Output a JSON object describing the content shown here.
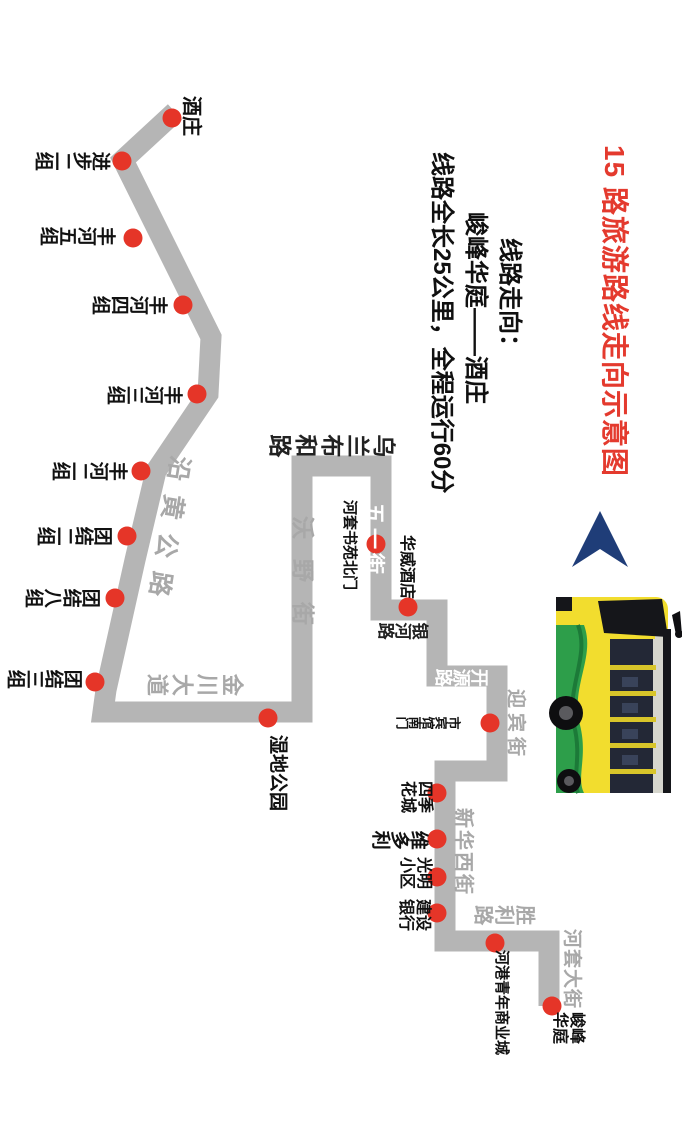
{
  "title": {
    "text": "15 路旅游路线走向示意图",
    "color": "#e43a2e"
  },
  "info": {
    "line1": "线路走向：",
    "line2": "峻峰华庭——酒庄",
    "line3": "线路全长25公里，全程运行60分"
  },
  "route": {
    "color": "#b5b5b5",
    "width": 21,
    "points": [
      [
        175,
        112
      ],
      [
        123,
        160
      ],
      [
        211,
        337
      ],
      [
        208,
        394
      ],
      [
        156,
        471
      ],
      [
        135,
        560
      ],
      [
        106,
        690
      ],
      [
        103,
        712
      ],
      [
        302,
        712
      ],
      [
        302,
        466
      ],
      [
        381,
        466
      ],
      [
        381,
        610
      ],
      [
        437,
        610
      ],
      [
        437,
        676
      ],
      [
        497,
        676
      ],
      [
        497,
        771
      ],
      [
        445,
        771
      ],
      [
        445,
        941
      ],
      [
        549,
        941
      ],
      [
        549,
        1006
      ]
    ]
  },
  "stops": {
    "color": "#e53528",
    "radius": 9.5,
    "items": [
      {
        "name": "酒庄",
        "x": 172,
        "y": 118,
        "type": "A",
        "lx": 201,
        "ly": 96,
        "size": 20
      },
      {
        "name": "进步二组",
        "x": 122,
        "y": 161,
        "type": "B",
        "lx": 111,
        "ly": 149,
        "size": 19
      },
      {
        "name": "丰河五组",
        "x": 133,
        "y": 238,
        "type": "B",
        "lx": 116,
        "ly": 224,
        "size": 19
      },
      {
        "name": "丰河四组",
        "x": 183,
        "y": 305,
        "type": "B",
        "lx": 168,
        "ly": 293,
        "size": 19
      },
      {
        "name": "丰河三组",
        "x": 197,
        "y": 394,
        "type": "B",
        "lx": 183,
        "ly": 383,
        "size": 19
      },
      {
        "name": "丰河二组",
        "x": 141,
        "y": 471,
        "type": "B",
        "lx": 128,
        "ly": 459,
        "size": 19
      },
      {
        "name": "团结二组",
        "x": 127,
        "y": 536,
        "type": "B",
        "lx": 113,
        "ly": 524,
        "size": 19
      },
      {
        "name": "团结八组",
        "x": 115,
        "y": 598,
        "type": "B",
        "lx": 101,
        "ly": 586,
        "size": 19
      },
      {
        "name": "团结三组",
        "x": 95,
        "y": 682,
        "type": "B",
        "lx": 83,
        "ly": 667,
        "size": 19
      },
      {
        "name": "湿地公园",
        "x": 268,
        "y": 718,
        "type": "A",
        "lx": 287,
        "ly": 735,
        "size": 19
      },
      {
        "name": "河套书苑北门",
        "x": 376,
        "y": 544,
        "type": "A",
        "lx": 357,
        "ly": 500,
        "size": 15
      },
      {
        "name": "华威酒店",
        "x": 408,
        "y": 607,
        "type": "A",
        "lx": 414,
        "ly": 535,
        "size": 16
      },
      {
        "name": "市宾馆南门",
        "x": 490,
        "y": 723,
        "type": "B",
        "lx": 461,
        "ly": 715,
        "size": 13
      },
      {
        "name": "四季花城",
        "text": "四季\n花城",
        "x": 437,
        "y": 793,
        "type": "C",
        "lx": 432,
        "ly": 781,
        "size": 16
      },
      {
        "name": "维多利",
        "x": 437,
        "y": 839,
        "type": "B",
        "lx": 429,
        "ly": 828,
        "size": 19
      },
      {
        "name": "光明小区",
        "text": "光明\n小区",
        "x": 437,
        "y": 877,
        "type": "C",
        "lx": 431,
        "ly": 857,
        "size": 16
      },
      {
        "name": "建设银行",
        "text": "建设\n银行",
        "x": 437,
        "y": 913,
        "type": "C",
        "lx": 430,
        "ly": 899,
        "size": 16
      },
      {
        "name": "河港青年商业城",
        "x": 495,
        "y": 943,
        "type": "A",
        "lx": 509,
        "ly": 950,
        "size": 15
      },
      {
        "name": "峻峰华庭",
        "text": "峻峰\n华庭",
        "x": 552,
        "y": 1006,
        "type": "C",
        "lx": 584,
        "ly": 1012,
        "size": 16
      }
    ]
  },
  "roads": {
    "items": [
      {
        "name": "沿黄公路",
        "type": "A",
        "lx": 193,
        "ly": 458,
        "size": 25,
        "spacing": 14,
        "angle": 99,
        "color": "#a8a8a8",
        "weight": 600
      },
      {
        "name": "金川大道",
        "type": "B",
        "lx": 244,
        "ly": 671,
        "size": 22,
        "spacing": 3,
        "color": "#a8a8a8",
        "weight": 600
      },
      {
        "name": "沃野街",
        "type": "A",
        "lx": 314,
        "ly": 516,
        "size": 23,
        "spacing": 20,
        "color": "#a8a8a8",
        "weight": 600
      },
      {
        "name": "乌兰布和路",
        "type": "B",
        "lx": 396,
        "ly": 431,
        "size": 23,
        "spacing": 3,
        "color": "#222222",
        "weight": 700
      },
      {
        "name": "五一街",
        "type": "A",
        "lx": 384,
        "ly": 503,
        "size": 21,
        "spacing": 4,
        "color": "#ffffff",
        "weight": 700
      },
      {
        "name": "银河路",
        "type": "B",
        "lx": 429,
        "ly": 620,
        "size": 17,
        "spacing": 0,
        "color": "#222222",
        "weight": 700
      },
      {
        "name": "开源路",
        "type": "B",
        "lx": 489,
        "ly": 667,
        "size": 18,
        "spacing": 0,
        "color": "#ffffff",
        "weight": 700
      },
      {
        "name": "迎宾街",
        "type": "A",
        "lx": 525,
        "ly": 689,
        "size": 19,
        "spacing": 5,
        "color": "#a8a8a8",
        "weight": 600
      },
      {
        "name": "新华西街",
        "type": "A",
        "lx": 473,
        "ly": 808,
        "size": 20,
        "spacing": 2,
        "color": "#a8a8a8",
        "weight": 600
      },
      {
        "name": "胜利路",
        "type": "B",
        "lx": 536,
        "ly": 902,
        "size": 20,
        "spacing": 1,
        "color": "#a8a8a8",
        "weight": 600
      },
      {
        "name": "河套大街",
        "type": "A",
        "lx": 581,
        "ly": 929,
        "size": 19,
        "spacing": 1,
        "color": "#a8a8a8",
        "weight": 600
      }
    ]
  },
  "north_arrow": {
    "color": "#1f3d78"
  },
  "bus": {
    "body": "#f2dd2e",
    "dark": "#15161a",
    "window": "#232836",
    "accent": "#2d9e4a",
    "silver": "#d6d6cd"
  }
}
